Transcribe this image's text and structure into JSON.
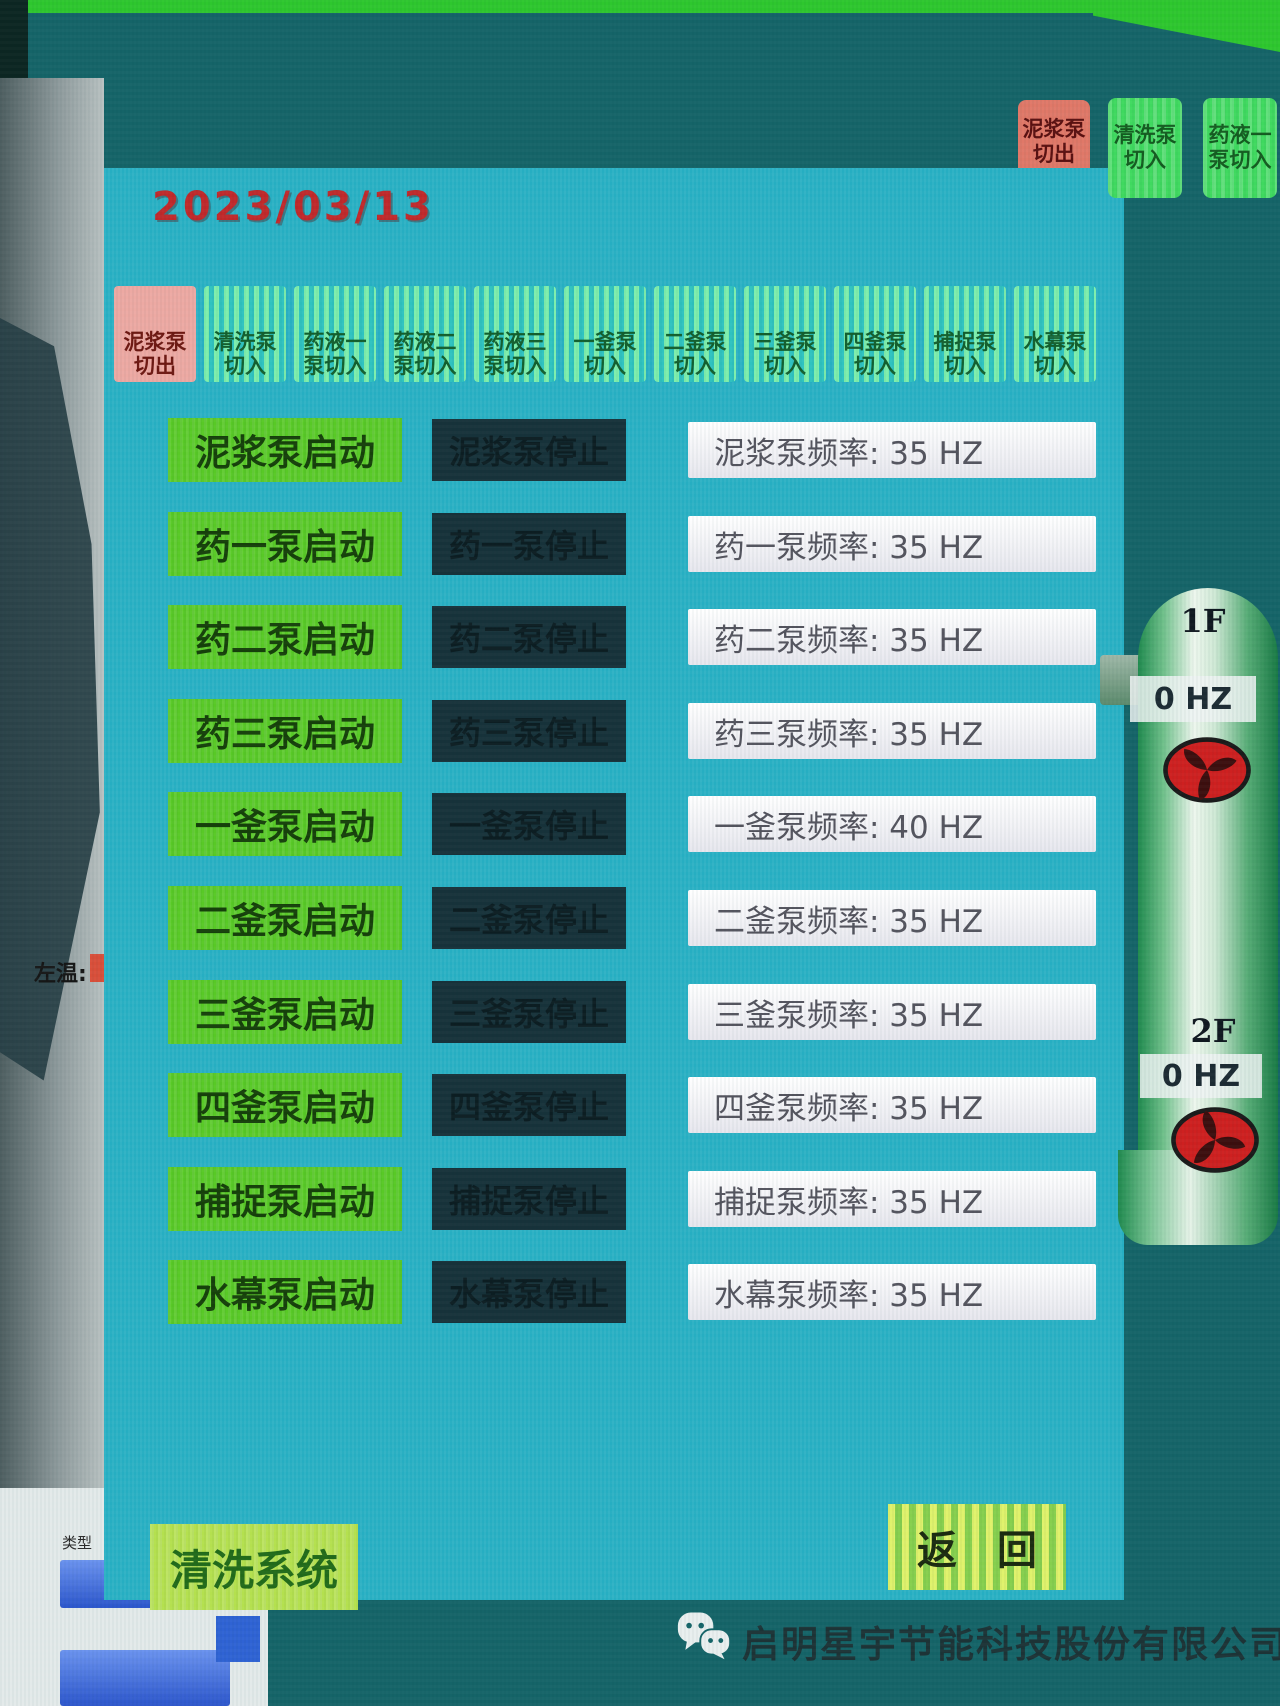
{
  "date": "2023/03/13",
  "corner_buttons": [
    {
      "line1": "泥浆泵",
      "line2": "切出"
    },
    {
      "line1": "清洗泵",
      "line2": "切入"
    },
    {
      "line1": "药液一",
      "line2": "泵切入"
    }
  ],
  "tabs": [
    {
      "line1": "泥浆泵",
      "line2": "切出"
    },
    {
      "line1": "清洗泵",
      "line2": "切入"
    },
    {
      "line1": "药液一",
      "line2": "泵切入"
    },
    {
      "line1": "药液二",
      "line2": "泵切入"
    },
    {
      "line1": "药液三",
      "line2": "泵切入"
    },
    {
      "line1": "一釜泵",
      "line2": "切入"
    },
    {
      "line1": "二釜泵",
      "line2": "切入"
    },
    {
      "line1": "三釜泵",
      "line2": "切入"
    },
    {
      "line1": "四釜泵",
      "line2": "切入"
    },
    {
      "line1": "捕捉泵",
      "line2": "切入"
    },
    {
      "line1": "水幕泵",
      "line2": "切入"
    }
  ],
  "rows": [
    {
      "start": "泥浆泵启动",
      "stop": "泥浆泵停止",
      "freq": "泥浆泵频率: 35 HZ"
    },
    {
      "start": "药一泵启动",
      "stop": "药一泵停止",
      "freq": "药一泵频率: 35 HZ"
    },
    {
      "start": "药二泵启动",
      "stop": "药二泵停止",
      "freq": "药二泵频率: 35 HZ"
    },
    {
      "start": "药三泵启动",
      "stop": "药三泵停止",
      "freq": "药三泵频率: 35 HZ"
    },
    {
      "start": "一釜泵启动",
      "stop": "一釜泵停止",
      "freq": "一釜泵频率: 40 HZ"
    },
    {
      "start": "二釜泵启动",
      "stop": "二釜泵停止",
      "freq": "二釜泵频率: 35 HZ"
    },
    {
      "start": "三釜泵启动",
      "stop": "三釜泵停止",
      "freq": "三釜泵频率: 35 HZ"
    },
    {
      "start": "四釜泵启动",
      "stop": "四釜泵停止",
      "freq": "四釜泵频率: 35 HZ"
    },
    {
      "start": "捕捉泵启动",
      "stop": "捕捉泵停止",
      "freq": "捕捉泵频率: 35 HZ"
    },
    {
      "start": "水幕泵启动",
      "stop": "水幕泵停止",
      "freq": "水幕泵频率: 35 HZ"
    }
  ],
  "footer": {
    "clean_system": "清洗系统",
    "back": "返　回"
  },
  "vessel": {
    "fan1_label": "1F",
    "fan1_freq": "0 HZ",
    "fan2_label": "2F",
    "fan2_freq": "0 HZ"
  },
  "left_window": {
    "temp_label": "左温:",
    "type_label": "类型"
  },
  "watermark": {
    "company": "启明星宇节能科技股份有限公司"
  },
  "colors": {
    "panel_cyan": "#27b3c7",
    "start_green": "#58c926",
    "stop_dark": "#17323a",
    "alarm_pink": "#e07868",
    "date_red": "#c1292b",
    "fan_red": "#ce2020",
    "background_teal": "#156468"
  }
}
